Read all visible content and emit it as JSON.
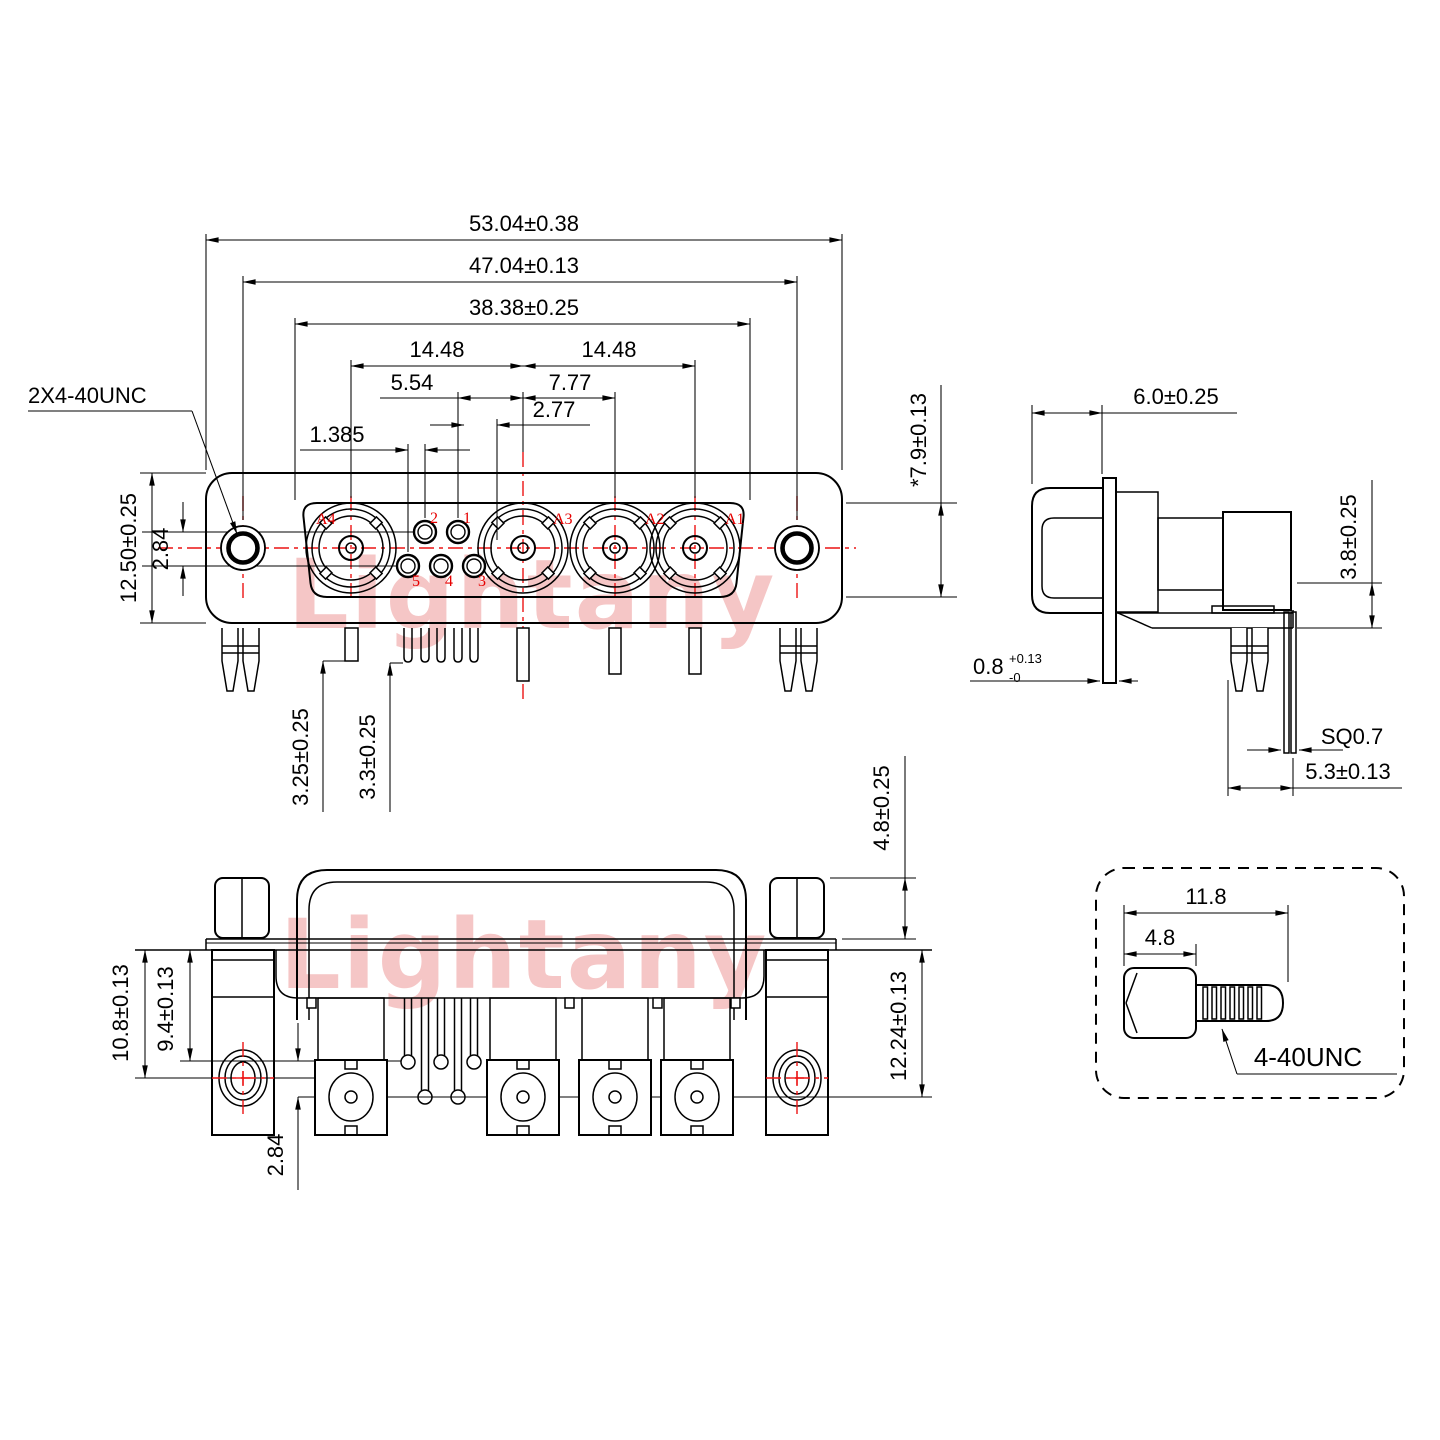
{
  "watermark": {
    "text": "Lightany",
    "color": "#f5c6c6"
  },
  "colors": {
    "line": "#000000",
    "accent_red": "#ec1414",
    "label_red": "#e60000"
  },
  "front_view": {
    "thread_label": "2X4-40UNC",
    "dims": {
      "overall_width": "53.04±0.38",
      "hole_span": "47.04±0.13",
      "dshell_width": "38.38±0.25",
      "pitch_left": "14.48",
      "pitch_right": "14.48",
      "pin_to_center": "5.54",
      "coax_pitch": "7.77",
      "pin_pitch": "2.77",
      "row_stagger": "1.385",
      "body_height": "12.50±0.25",
      "row_offset": "2.84",
      "leg_a": "3.25±0.25",
      "leg_b": "3.3±0.25",
      "dshell_height": "*7.9±0.13"
    },
    "contact_labels": {
      "a1": "A1",
      "a2": "A2",
      "a3": "A3",
      "a4": "A4",
      "p1": "1",
      "p2": "2",
      "p3": "3",
      "p4": "4",
      "p5": "5"
    }
  },
  "side_view": {
    "dims": {
      "front_depth": "6.0±0.25",
      "standoff": "3.8±0.25",
      "flange_thickness": "0.8",
      "flange_tol_plus": "+0.13",
      "flange_tol_minus": "-0",
      "pin_square": "SQ0.7",
      "pin_offset": "5.3±0.13"
    }
  },
  "rear_view": {
    "dims": {
      "plate_to_hole": "10.8±0.13",
      "plate_to_pins": "9.4±0.13",
      "row_offset": "2.84",
      "screw_height": "4.8±0.25",
      "plate_to_contacts": "12.24±0.13"
    }
  },
  "screw_detail": {
    "dims": {
      "overall_length": "11.8",
      "head_length": "4.8"
    },
    "thread_label": "4-40UNC"
  }
}
